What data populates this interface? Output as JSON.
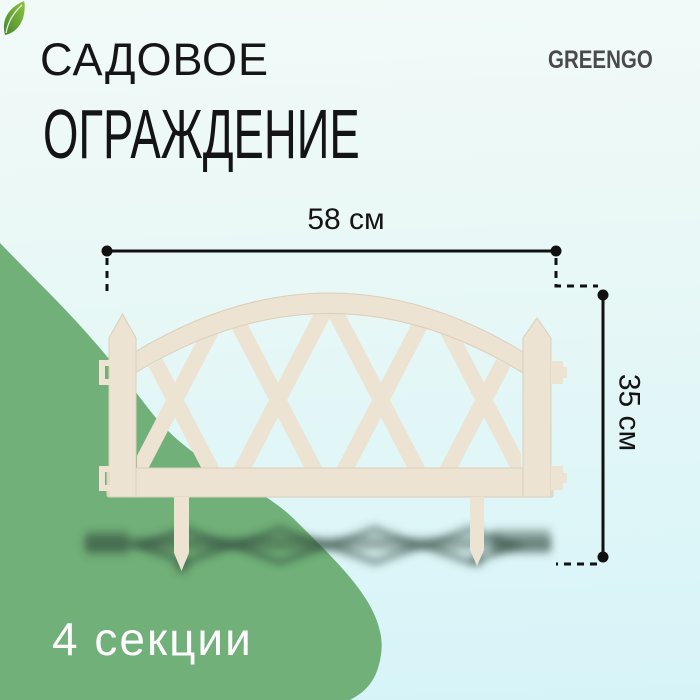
{
  "title": {
    "line1": "САДОВОЕ",
    "line2": "ОГРАЖДЕНИЕ"
  },
  "brand": {
    "name": "GREENGO"
  },
  "dimensions": {
    "width": "58 см",
    "height": "35 см"
  },
  "badge": {
    "sections": "4 секции"
  },
  "colors": {
    "background_top": "#f2faf8",
    "background_bottom": "#d6f4f8",
    "blob_green": "#71b078",
    "fence_cream": "#ece3d3",
    "fence_edge": "#dccfba",
    "shadow_ink": "rgba(45,70,58,0.42)",
    "title_text": "#141414",
    "dimension_ink": "#111111",
    "brand_text": "#4a4a4a",
    "leaf_dark": "#47862f",
    "leaf_light": "#8ec63f",
    "badge_text": "#ffffff"
  }
}
